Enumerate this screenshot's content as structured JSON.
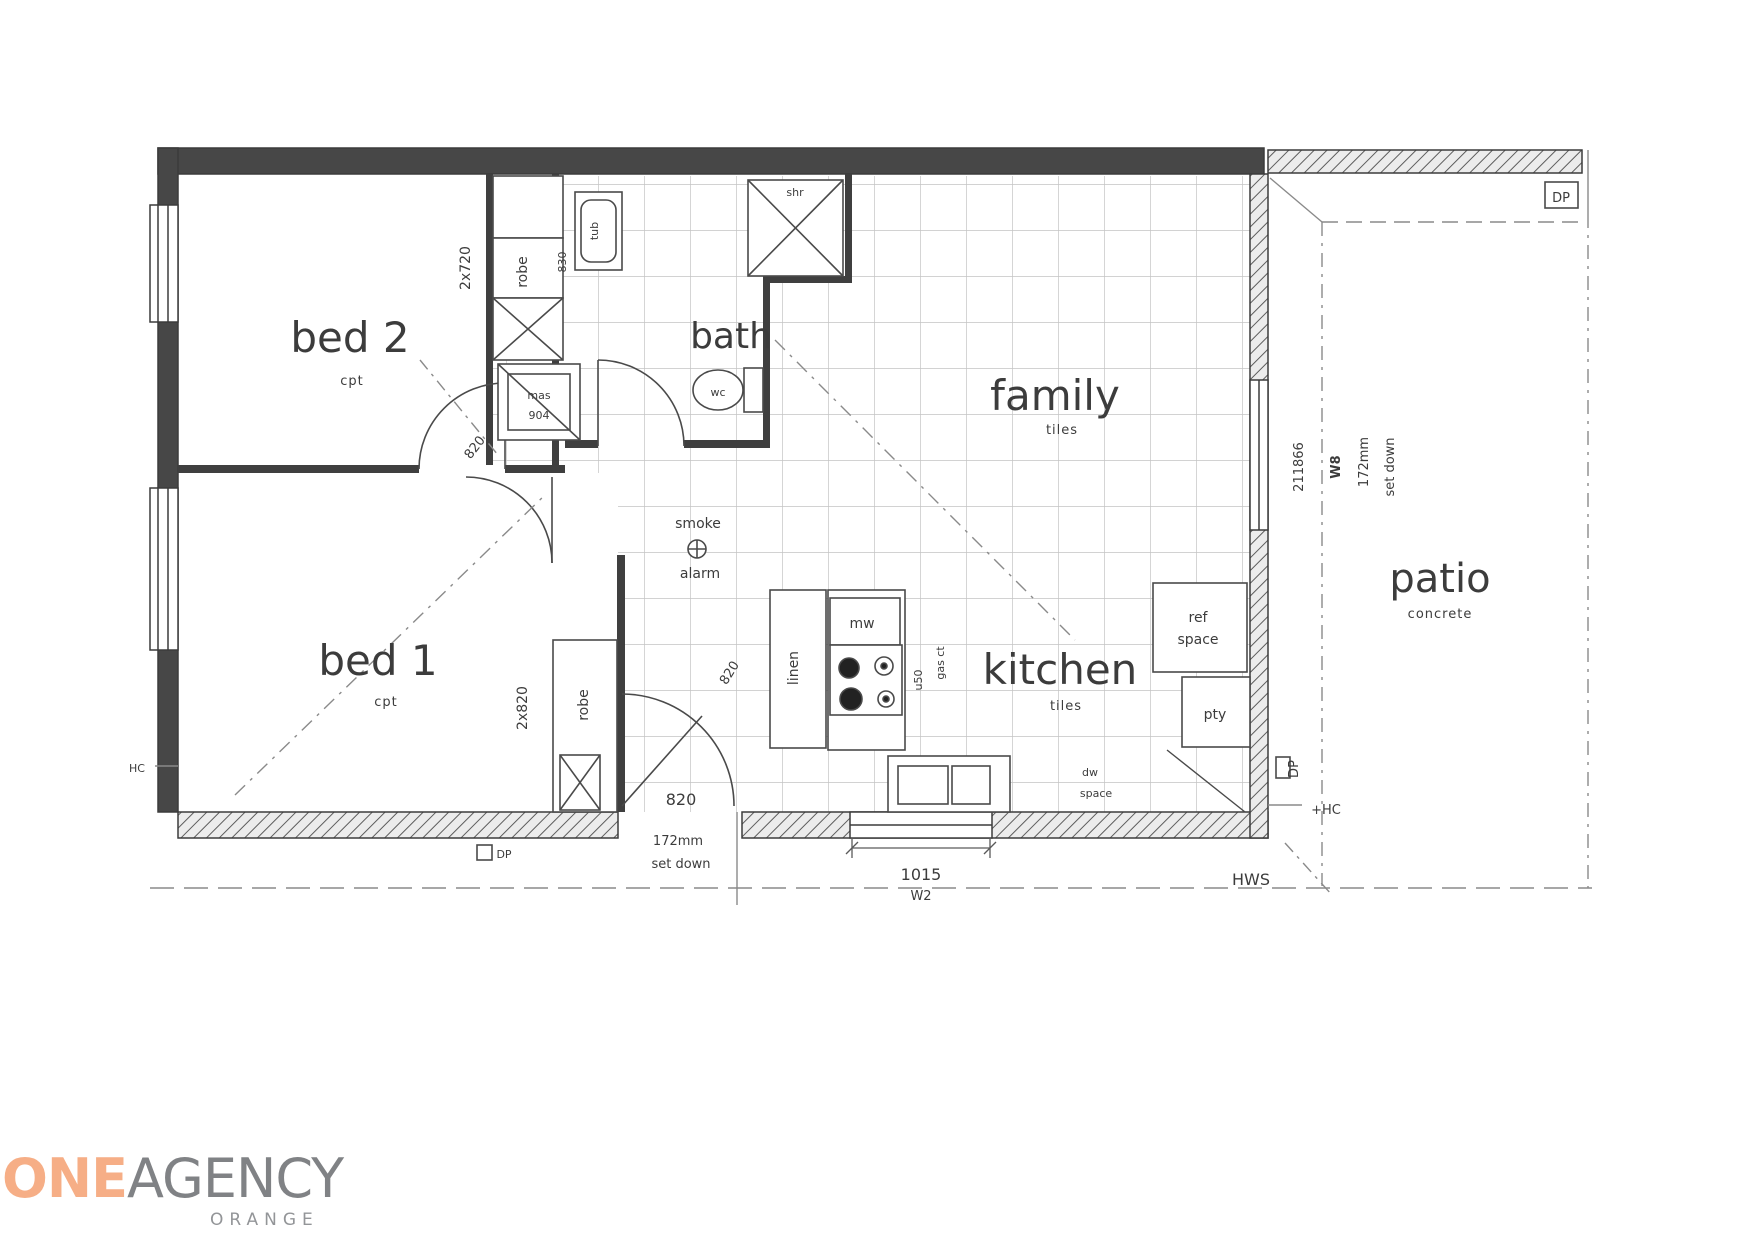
{
  "plan": {
    "rooms": {
      "bed2": {
        "label": "bed 2",
        "sub": "cpt"
      },
      "bed1": {
        "label": "bed 1",
        "sub": "cpt"
      },
      "bath": {
        "label": "bath"
      },
      "family": {
        "label": "family",
        "sub": "tiles"
      },
      "kitchen": {
        "label": "kitchen",
        "sub": "tiles"
      },
      "patio": {
        "label": "patio",
        "sub": "concrete"
      }
    },
    "fixtures": {
      "robe_bed2": "robe",
      "robe_bed2_size": "2x720",
      "robe_bed1": "robe",
      "robe_bed1_size": "2x820",
      "tub": "tub",
      "tub_size": "830",
      "shower": "shr",
      "wc": "wc",
      "vanity_line1": "mas",
      "vanity_line2": "904",
      "linen": "linen",
      "microwave": "mw",
      "cooktop_line1": "u50",
      "cooktop_line2": "gas ct",
      "fridge_line1": "ref",
      "fridge_line2": "space",
      "pantry": "pty",
      "dishwasher_line1": "dw",
      "dishwasher_line2": "space",
      "smoke_line1": "smoke",
      "smoke_line2": "alarm"
    },
    "dimensions": {
      "entry_door": "820",
      "entry_setdown_line1": "172mm",
      "entry_setdown_line2": "set down",
      "door_bed": "820",
      "door_hall": "820",
      "window_w2_size": "1015",
      "window_w2": "W2",
      "patio_length": "211866",
      "window_w8": "W8",
      "patio_setdown_line1": "172mm",
      "patio_setdown_line2": "set down"
    },
    "services": {
      "hws": "HWS",
      "hc": "+HC",
      "hc_left": "HC",
      "dp": "DP"
    }
  },
  "logo": {
    "one": "ONE",
    "agency": "AGENCY",
    "suburb": "ORANGE",
    "one_color": "#f6ae86",
    "agency_color": "#808285",
    "suburb_color": "#939598"
  }
}
